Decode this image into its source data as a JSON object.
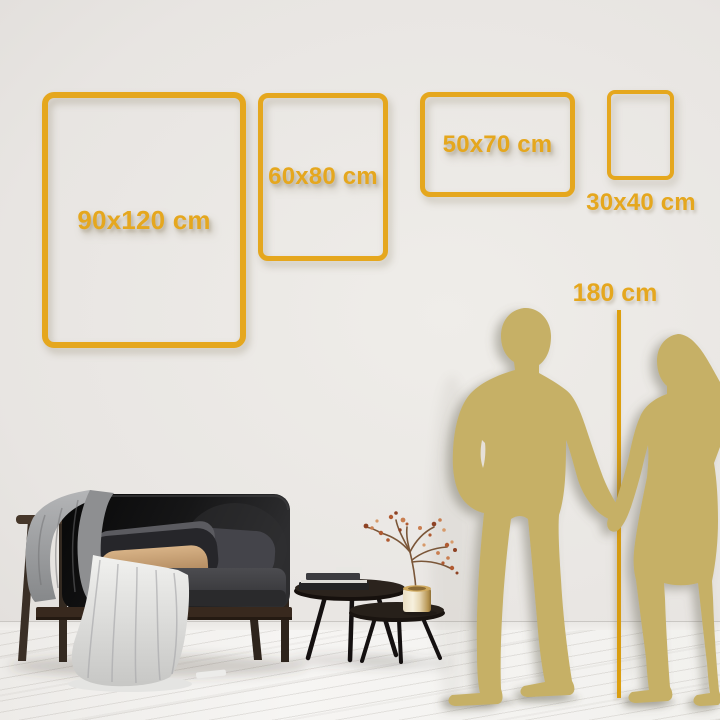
{
  "size_guide": {
    "frames": [
      {
        "id": "90x120",
        "label": "90x120 cm",
        "orientation": "portrait"
      },
      {
        "id": "60x80",
        "label": "60x80 cm",
        "orientation": "portrait"
      },
      {
        "id": "50x70",
        "label": "50x70 cm",
        "orientation": "landscape"
      },
      {
        "id": "30x40",
        "label": "30x40 cm",
        "orientation": "portrait"
      }
    ],
    "height_reference": {
      "label": "180 cm"
    }
  },
  "colors": {
    "accent_gold": "#E5A71E",
    "measure_line": "#DD9F0E",
    "silhouette": "#C6B066"
  }
}
